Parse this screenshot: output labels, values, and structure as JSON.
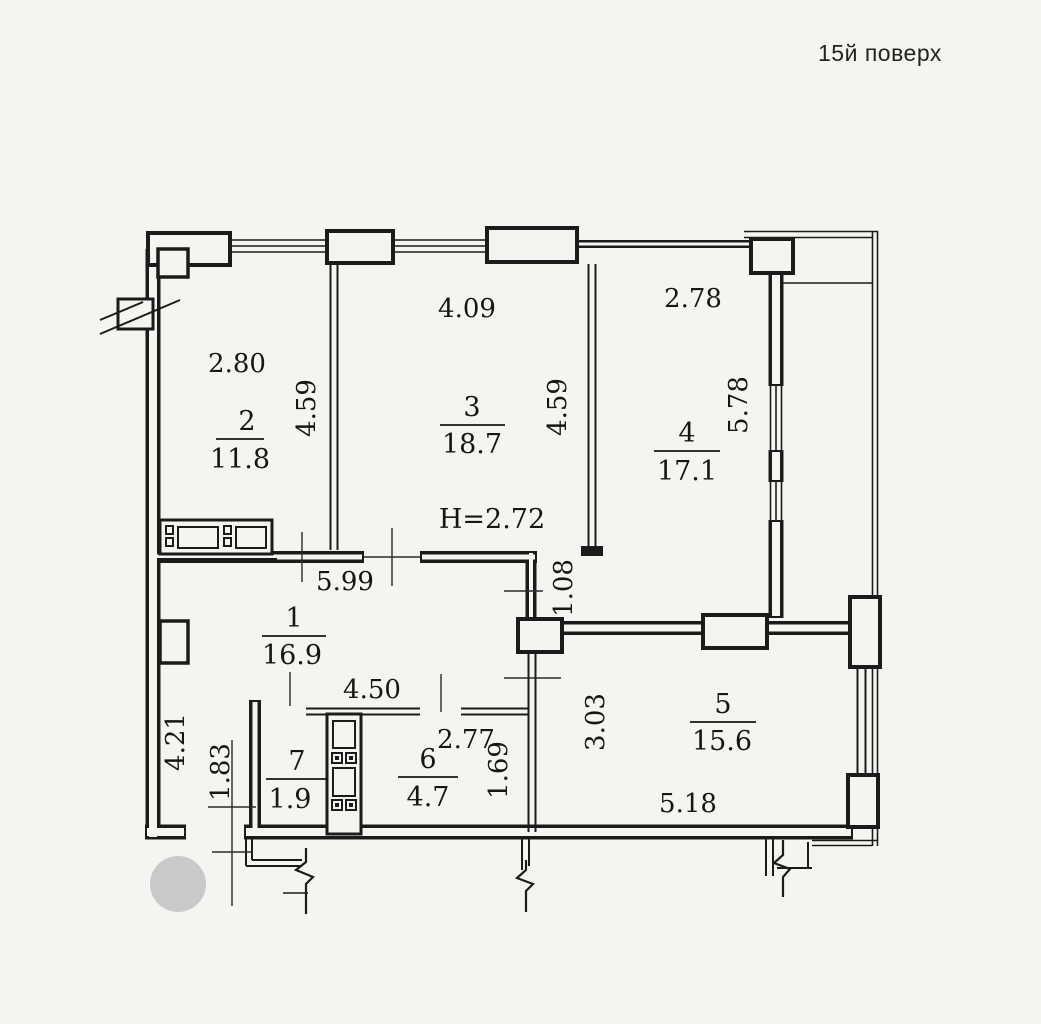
{
  "title": "15й поверх",
  "colors": {
    "paper": "#f6f4f1",
    "ink": "#1b1b1b",
    "watermark": "#c9c9c9"
  },
  "ceiling_height": "Н=2.72",
  "rooms": [
    {
      "num": "1",
      "area": "16.9"
    },
    {
      "num": "2",
      "area": "11.8"
    },
    {
      "num": "3",
      "area": "18.7"
    },
    {
      "num": "4",
      "area": "17.1"
    },
    {
      "num": "5",
      "area": "15.6"
    },
    {
      "num": "6",
      "area": "4.7"
    },
    {
      "num": "7",
      "area": "1.9"
    }
  ],
  "dims": {
    "room2_width": "2.80",
    "room3_width": "4.09",
    "room4_width": "2.78",
    "room2_height": "4.59",
    "room3_height": "4.59",
    "room4_height": "5.78",
    "room1_width": "5.99",
    "hall_nook": "1.08",
    "bath_block_width": "4.50",
    "room6_width": "2.77",
    "room6_height": "1.69",
    "room5_height": "3.03",
    "room1_height": "4.21",
    "entry_width": "1.83",
    "room5_width": "5.18"
  }
}
